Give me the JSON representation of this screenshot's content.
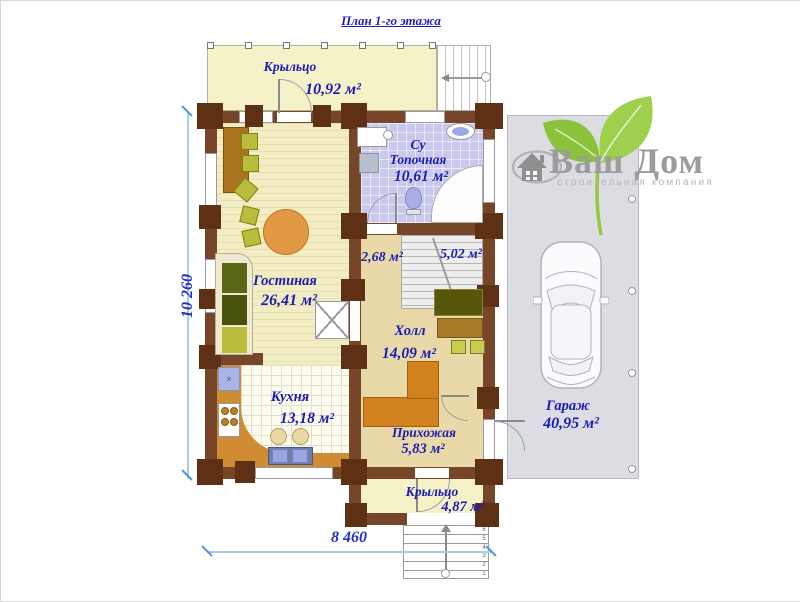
{
  "title": "План 1-го этажа",
  "rooms": {
    "porch_top": {
      "label": "Крыльцо",
      "area": "10,92 м²"
    },
    "bathroom": {
      "line1": "Су",
      "line2": "Топочная",
      "area": "10,61 м²"
    },
    "under_stairs": {
      "area": "2,68 м²"
    },
    "stairs": {
      "area": "5,02 м²"
    },
    "living": {
      "label": "Гостиная",
      "area": "26,41 м²"
    },
    "hall": {
      "label": "Холл",
      "area": "14,09 м²"
    },
    "kitchen": {
      "label": "Кухня",
      "area": "13,18 м²"
    },
    "entry": {
      "label": "Прихожая",
      "area": "5,83 м²"
    },
    "porch_bottom": {
      "label": "Крыльцо",
      "area": "4,87 м²"
    },
    "garage": {
      "label": "Гараж",
      "area": "40,95 м²"
    }
  },
  "dimensions": {
    "vertical": "10 260",
    "horizontal": "8 460"
  },
  "logo": {
    "name": "Ваш Дом",
    "tagline": "строительная компания"
  },
  "steps": [
    "6",
    "5",
    "4",
    "3",
    "2",
    "1"
  ],
  "symbols": {
    "sink_mark": "×"
  },
  "colors": {
    "label_blue": "#1b1bb4",
    "dimension_blue": "#2130c4",
    "wall_brown": "#774528",
    "log_brown": "#5e3115",
    "logo_green": "#96c83e",
    "garage_gray": "#dcdce3"
  }
}
